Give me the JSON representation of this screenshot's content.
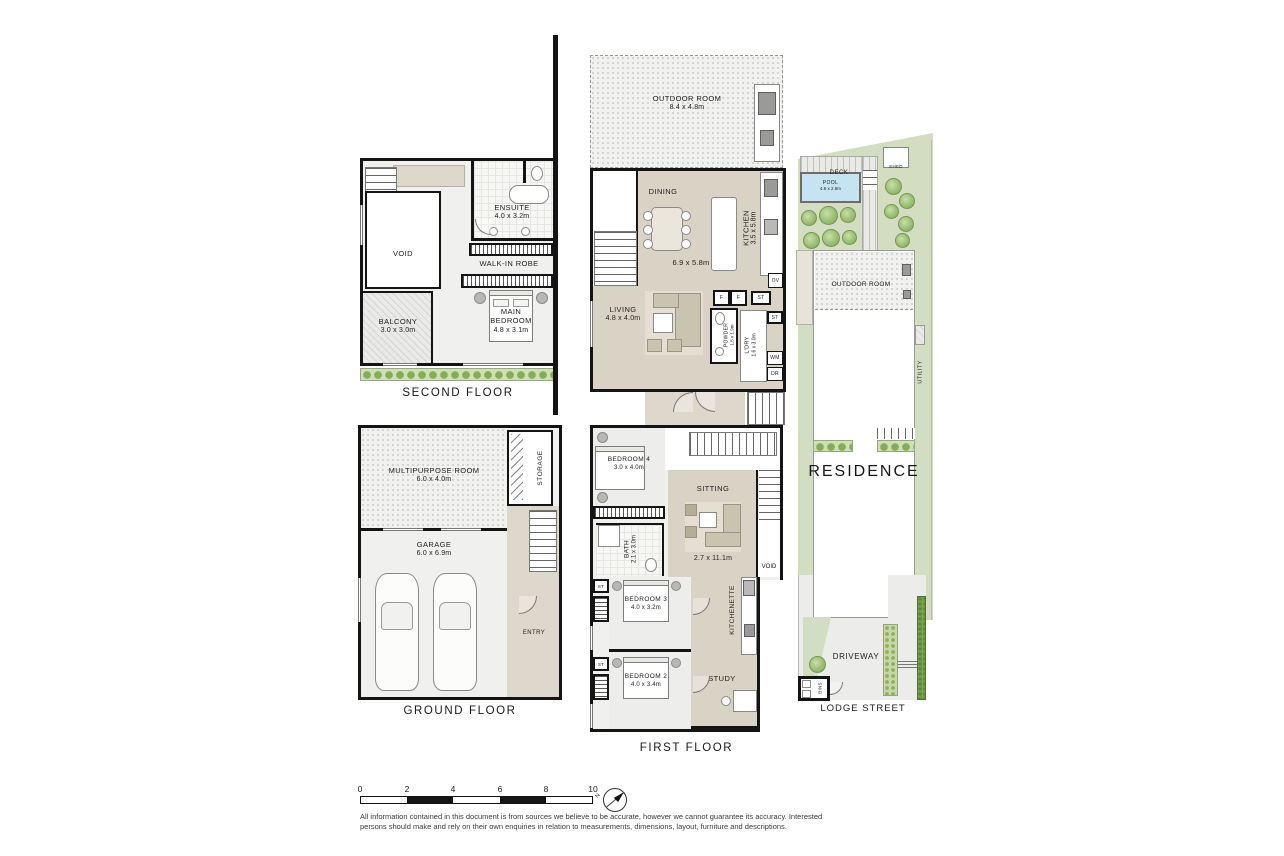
{
  "second_floor": {
    "title": "SECOND FLOOR",
    "void": "VOID",
    "ensuite_name": "ENSUITE",
    "ensuite_dims": "4.0 x 3.2m",
    "robe": "WALK-IN ROBE",
    "main_bedroom_name": "MAIN BEDROOM",
    "main_bedroom_dims": "4.8 x 3.1m",
    "balcony_name": "BALCONY",
    "balcony_dims": "3.0 x 3.0m"
  },
  "main_level": {
    "outdoor_name": "OUTDOOR ROOM",
    "outdoor_dims": "8.4 x 4.8m",
    "dining": "DINING",
    "kitchen_name": "KITCHEN",
    "kitchen_dims": "3.5 x 5.8m",
    "open_dims": "6.9 x 5.8m",
    "living_name": "LIVING",
    "living_dims": "4.8 x 4.0m",
    "powder_name": "POWDER",
    "powder_dims": "1.5 x 1.9m",
    "laundry_name": "L'DRY",
    "laundry_dims": "1.6 x 3.0m",
    "f1": "F",
    "f2": "F",
    "st1": "ST",
    "st2": "ST",
    "ov": "OV",
    "wm": "WM",
    "dr": "DR"
  },
  "first_floor": {
    "title": "FIRST FLOOR",
    "bedroom4_name": "BEDROOM 4",
    "bedroom4_dims": "3.0 x 4.0m",
    "sitting": "SITTING",
    "sitting_dims": "2.7 x 11.1m",
    "bath_name": "BATH",
    "bath_dims": "2.1 x 3.0m",
    "void": "VOID",
    "bedroom3_name": "BEDROOM 3",
    "bedroom3_dims": "4.0 x 3.2m",
    "bedroom2_name": "BEDROOM 2",
    "bedroom2_dims": "4.0 x 3.4m",
    "kitchenette": "KITCHENETTE",
    "study": "STUDY",
    "st1": "ST",
    "st2": "ST"
  },
  "ground_floor": {
    "title": "GROUND FLOOR",
    "multipurpose_name": "MULTIPURPOSE ROOM",
    "multipurpose_dims": "6.0 x 4.0m",
    "garage_name": "GARAGE",
    "garage_dims": "6.0 x 6.9m",
    "storage": "STORAGE",
    "entry": "ENTRY"
  },
  "site": {
    "street": "LODGE STREET",
    "residence": "RESIDENCE",
    "deck": "DECK",
    "shed": "SHED",
    "pool_name": "POOL",
    "pool_dims": "4.6 x 2.5m",
    "outdoor_room": "OUTDOOR ROOM",
    "utility": "UTILITY",
    "driveway": "DRIVEWAY",
    "bins": "BINS"
  },
  "scale_bar": {
    "ticks": [
      "0",
      "2",
      "4",
      "6",
      "8",
      "10"
    ]
  },
  "compass": {
    "letter": "N"
  },
  "disclaimer": {
    "line1": "All information contained in this document is from sources we believe to be accurate, however we cannot guarantee its accuracy. Interested",
    "line2": "persons should make and rely on their own enquiries in relation to measurements, dimensions, layout, furniture and descriptions."
  },
  "colors": {
    "wall": "#141414",
    "living_beige": "#d9d3c5",
    "floor_gray": "#f0f0ee",
    "garden_green": "#d2ddc1",
    "pool_blue": "#c6e3f1",
    "hedge_green": "#76a24c"
  }
}
